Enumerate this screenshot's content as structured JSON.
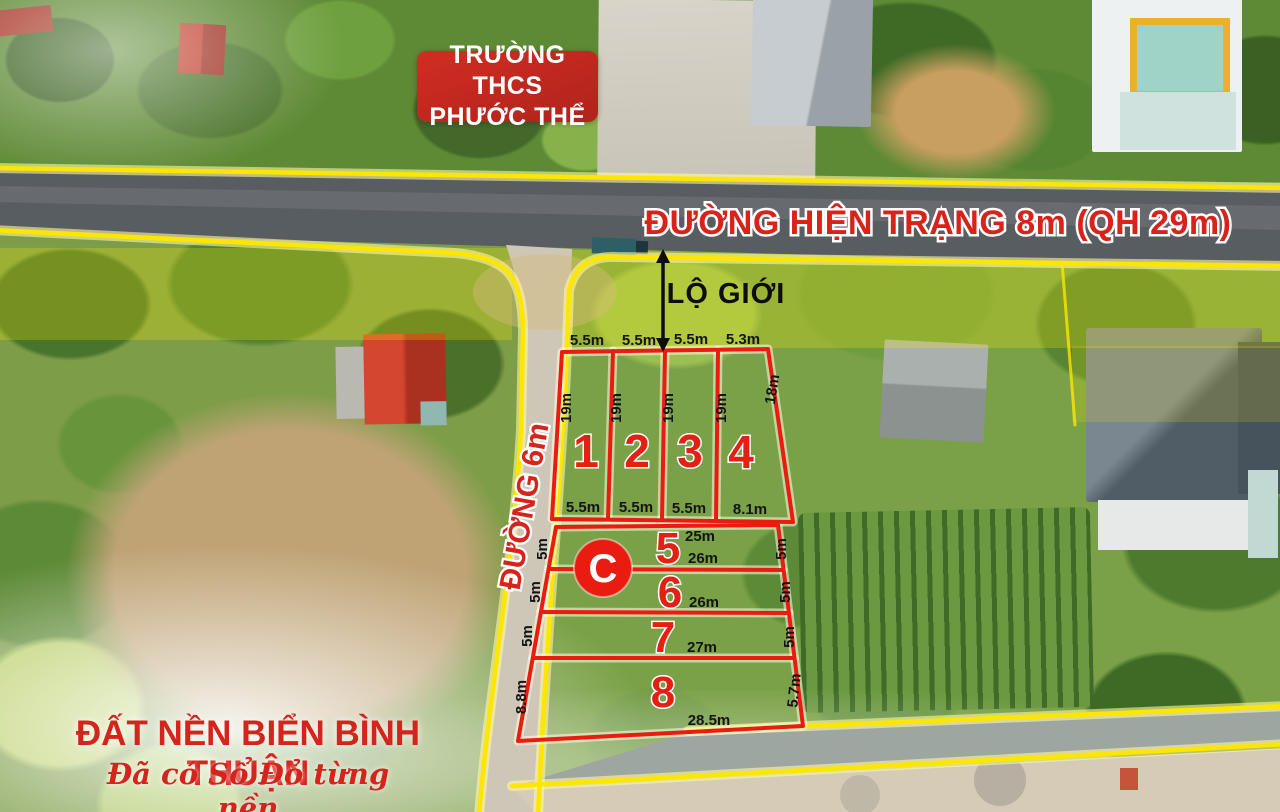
{
  "school_sign": {
    "line1": "TRƯỜNG THCS",
    "line2": "PHƯỚC THỂ"
  },
  "main_road": {
    "label": "ĐƯỜNG HIỆN TRẠNG 8m (QH 29m)"
  },
  "side_road": {
    "label": "ĐƯỜNG 6m"
  },
  "setback_label": "LỘ GIỚI",
  "section_marker": "C",
  "footer": {
    "title": "ĐẤT NỀN BIỂN BÌNH THUẬN",
    "subtitle": "Đã có Sổ Đỏ từng nền"
  },
  "plots_block_a": {
    "numbers": [
      "1",
      "2",
      "3",
      "4"
    ],
    "top_dims": [
      "5.5m",
      "5.5m",
      "5.5m",
      "5.3m"
    ],
    "side_dims": [
      "19m",
      "19m",
      "19m",
      "19m",
      "18m"
    ],
    "bottom_dims": [
      "5.5m",
      "5.5m",
      "5.5m",
      "8.1m"
    ]
  },
  "plots_block_b": {
    "numbers": [
      "5",
      "6",
      "7",
      "8"
    ],
    "width_dims": [
      "25m",
      "26m",
      "26m",
      "27m",
      "28.5m"
    ],
    "left_dims": [
      "5m",
      "5m",
      "5m",
      "8.8m"
    ],
    "right_dims": [
      "5m",
      "5m",
      "5m",
      "5.7m"
    ]
  },
  "colors": {
    "boundary_red": "#ea1c10",
    "road_line_yellow": "#ffe600",
    "label_red": "#d8231b",
    "sign_red": "#c9281e",
    "asphalt": "#585d62",
    "side_road_surface": "#cec7b7"
  }
}
